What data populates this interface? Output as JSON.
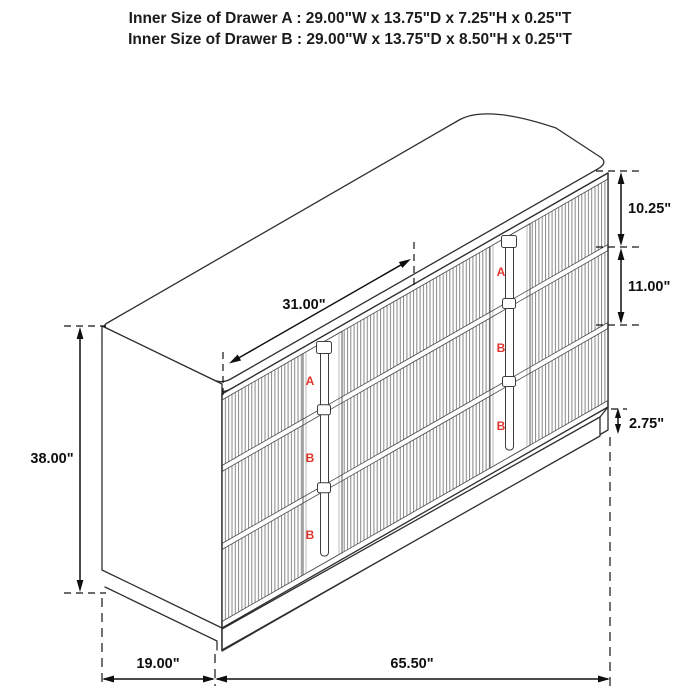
{
  "header": {
    "line_a": "Inner Size of Drawer A : 29.00\"W x 13.75\"D x 7.25\"H x 0.25\"T",
    "line_b": "Inner Size of Drawer B : 29.00\"W x 13.75\"D x 8.50\"H x 0.25\"T"
  },
  "dimensions": {
    "top_width": "31.00\"",
    "height": "38.00\"",
    "drawer_a_front_height": "10.25\"",
    "drawer_b_front_height": "11.00\"",
    "base_height": "2.75\"",
    "depth": "19.00\"",
    "total_width": "65.50\""
  },
  "drawer_labels": {
    "left_column": [
      "A",
      "B",
      "B"
    ],
    "right_column": [
      "A",
      "B",
      "B"
    ]
  },
  "colors": {
    "label_red": "#e1352c",
    "line_dark": "#2e2e2e",
    "flute_gray": "#868686"
  }
}
